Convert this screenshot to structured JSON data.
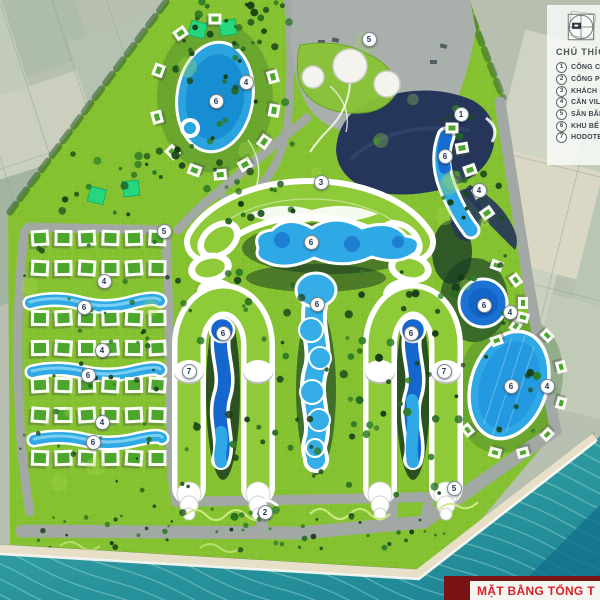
{
  "banner": {
    "strip_label": "MẶT BẰNG TỔNG T"
  },
  "legend": {
    "heading": "CHÚ THÍCH",
    "items": [
      {
        "num": "1",
        "label": "CỔNG CH"
      },
      {
        "num": "2",
        "label": "CỔNG PH"
      },
      {
        "num": "3",
        "label": "KHÁCH SẠ"
      },
      {
        "num": "4",
        "label": "CĂN VILLA"
      },
      {
        "num": "5",
        "label": "SÂN BÃI, Đ"
      },
      {
        "num": "6",
        "label": "KHU BỂ BƠ"
      },
      {
        "num": "7",
        "label": "HODOTEL"
      }
    ]
  },
  "plan": {
    "colors": {
      "site_green": "#84c12f",
      "building_green": "#8fca38",
      "pool_blue": "#2fa8e6",
      "pool_deep": "#1566cf",
      "road_gray": "#a2a9a4",
      "plaza_navy": "#25365a",
      "sea_teal": "#2e9aa0",
      "sand": "#e8dfc9",
      "emerald_lawn": "#27d77f",
      "banner_red": "#d6222a",
      "banner_strip": "#7a1316"
    },
    "markers": [
      {
        "n": "1",
        "x": 460,
        "y": 113
      },
      {
        "n": "2",
        "x": 264,
        "y": 511
      },
      {
        "n": "3",
        "x": 320,
        "y": 181
      },
      {
        "n": "4",
        "x": 245,
        "y": 81
      },
      {
        "n": "4",
        "x": 103,
        "y": 280
      },
      {
        "n": "4",
        "x": 101,
        "y": 349
      },
      {
        "n": "4",
        "x": 101,
        "y": 421
      },
      {
        "n": "4",
        "x": 478,
        "y": 189
      },
      {
        "n": "4",
        "x": 509,
        "y": 311
      },
      {
        "n": "4",
        "x": 546,
        "y": 385
      },
      {
        "n": "5",
        "x": 368,
        "y": 38
      },
      {
        "n": "5",
        "x": 163,
        "y": 230
      },
      {
        "n": "5",
        "x": 453,
        "y": 487
      },
      {
        "n": "6",
        "x": 215,
        "y": 100
      },
      {
        "n": "6",
        "x": 310,
        "y": 241
      },
      {
        "n": "6",
        "x": 222,
        "y": 332
      },
      {
        "n": "6",
        "x": 316,
        "y": 303
      },
      {
        "n": "6",
        "x": 410,
        "y": 332
      },
      {
        "n": "6",
        "x": 444,
        "y": 155
      },
      {
        "n": "6",
        "x": 483,
        "y": 304
      },
      {
        "n": "6",
        "x": 510,
        "y": 385
      },
      {
        "n": "6",
        "x": 83,
        "y": 306
      },
      {
        "n": "6",
        "x": 87,
        "y": 374
      },
      {
        "n": "6",
        "x": 92,
        "y": 441
      },
      {
        "n": "7",
        "x": 188,
        "y": 370
      },
      {
        "n": "7",
        "x": 443,
        "y": 370
      }
    ],
    "villas": {
      "grid": {
        "cols": 6,
        "x0": 40,
        "dx": 23.5,
        "rows": [
          238,
          268,
          318,
          348,
          385,
          415,
          458
        ],
        "w": 18,
        "h": 16
      },
      "rings": [
        {
          "cx": 215,
          "cy": 97,
          "rx": 60,
          "ry": 78,
          "angles": [
            -90,
            -125,
            -160,
            165,
            135,
            110,
            85,
            60,
            35,
            10,
            -15
          ],
          "s": 13
        },
        {
          "cx": 483,
          "cy": 303,
          "rx": 40,
          "ry": 40,
          "angles": [
            -70,
            -35,
            0,
            35,
            70
          ],
          "s": 12
        },
        {
          "cx": 509,
          "cy": 385,
          "rx": 54,
          "ry": 70,
          "angles": [
            -75,
            -45,
            -15,
            15,
            45,
            75,
            105,
            140
          ],
          "s": 12
        }
      ],
      "singles": [
        {
          "x": 452,
          "y": 128,
          "r": 0
        },
        {
          "x": 462,
          "y": 148,
          "r": -10
        },
        {
          "x": 470,
          "y": 170,
          "r": -20
        },
        {
          "x": 479,
          "y": 192,
          "r": -28
        },
        {
          "x": 487,
          "y": 213,
          "r": -35
        }
      ]
    }
  }
}
